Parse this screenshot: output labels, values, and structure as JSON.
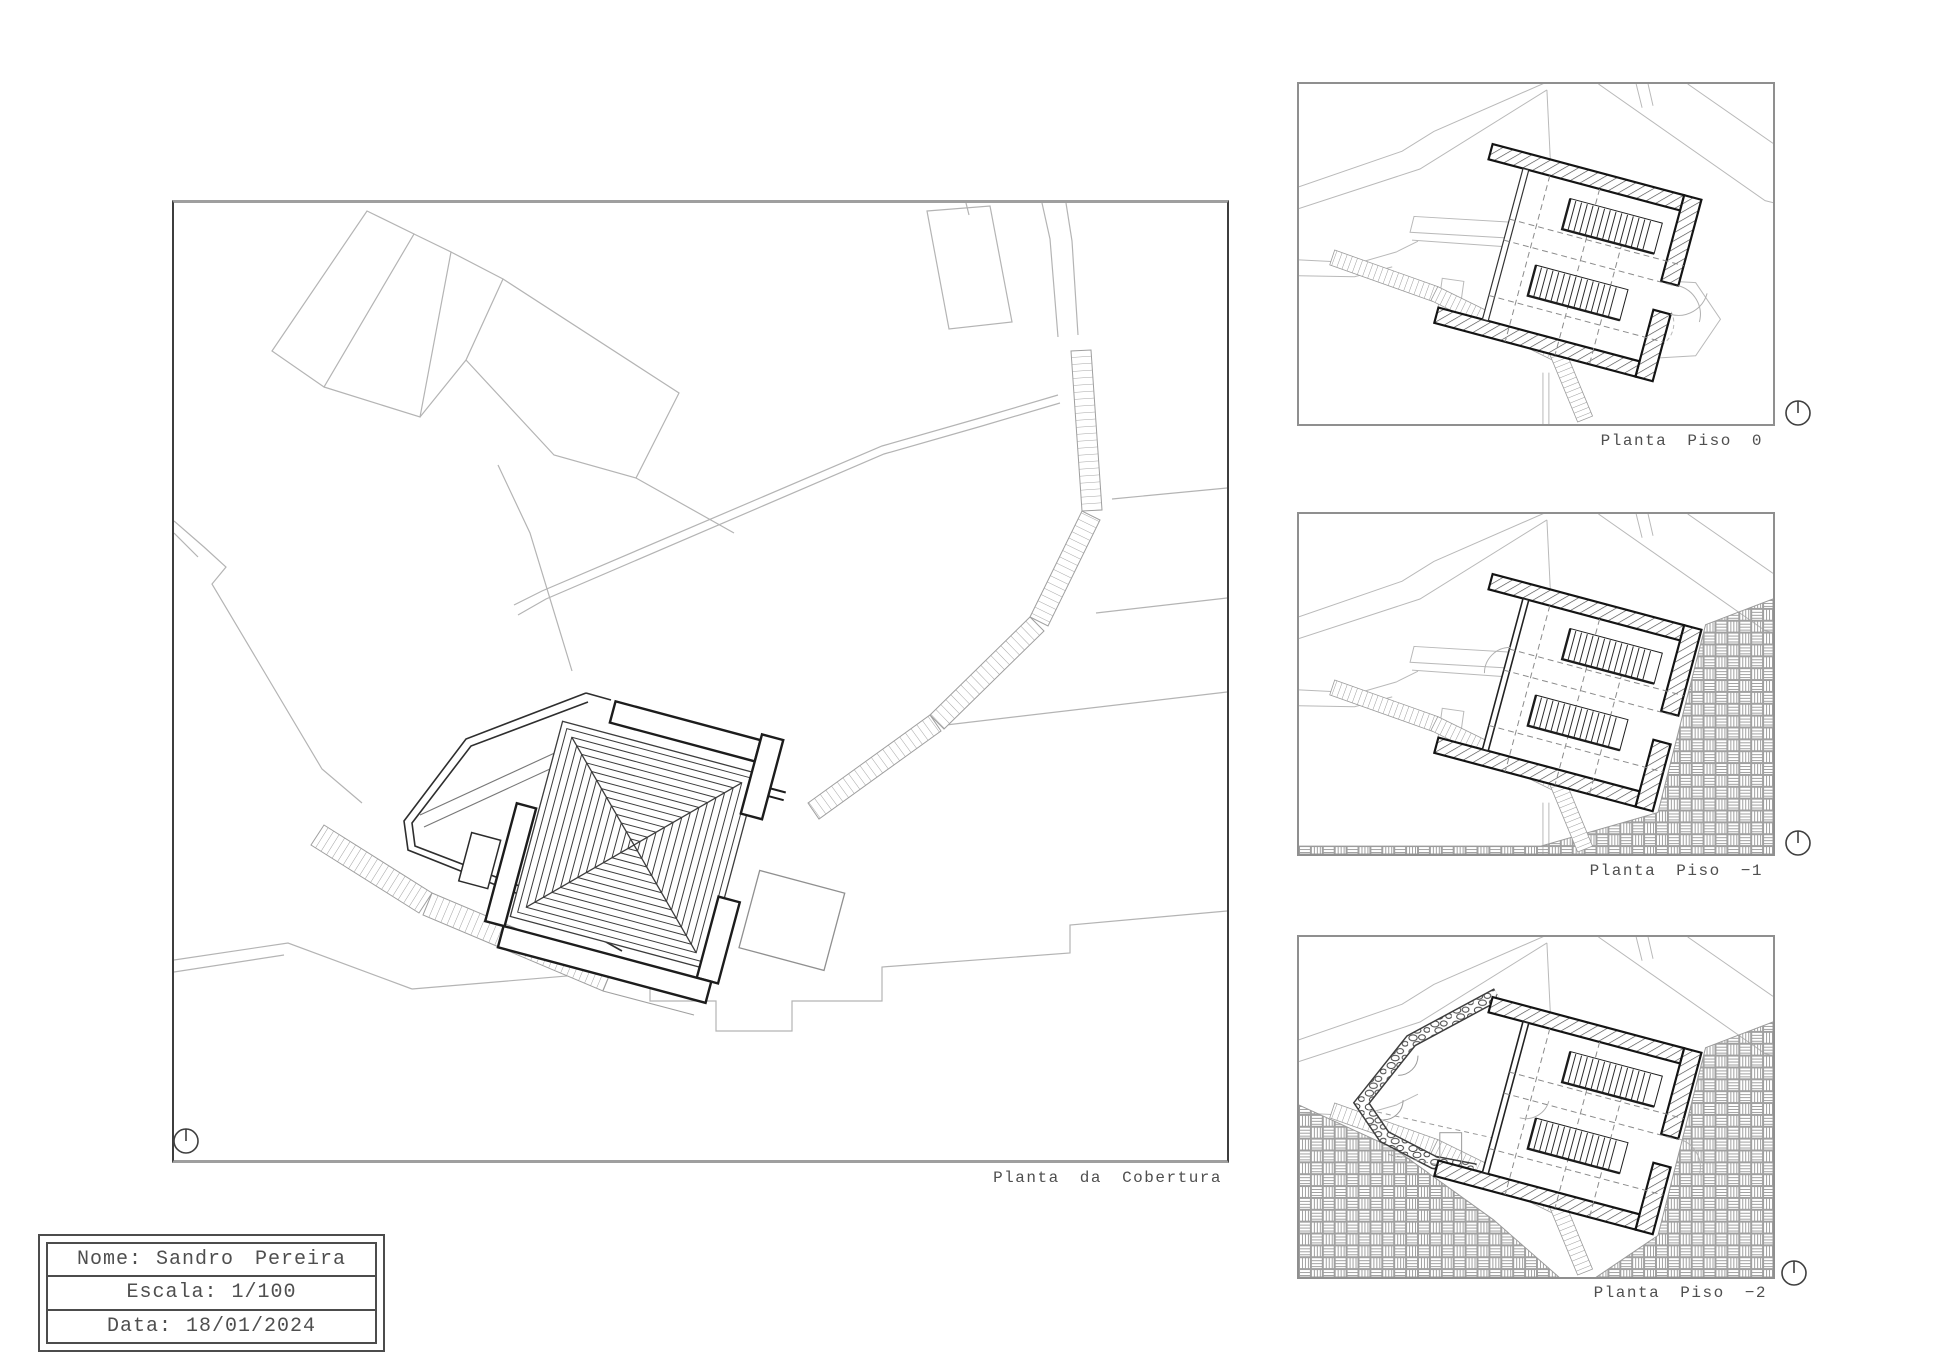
{
  "main_panel": {
    "label": "Planta da Cobertura"
  },
  "floor_panels": [
    {
      "label": "Planta Piso 0"
    },
    {
      "label": "Planta Piso −1"
    },
    {
      "label": "Planta Piso −2"
    }
  ],
  "title_block": {
    "rows": [
      {
        "label": "Nome:",
        "value": "Sandro Pereira"
      },
      {
        "label": "Escala:",
        "value": "1/100"
      },
      {
        "label": "Data:",
        "value": "18/01/2024"
      }
    ]
  },
  "icons": {
    "north": "north-arrow-icon"
  },
  "colors": {
    "site_line": "#b4b4b4",
    "wall_line": "#1c1c1c",
    "hatch_line": "#474747",
    "ground_hatch": "#a0a0a0",
    "text": "#4f4f4f"
  }
}
